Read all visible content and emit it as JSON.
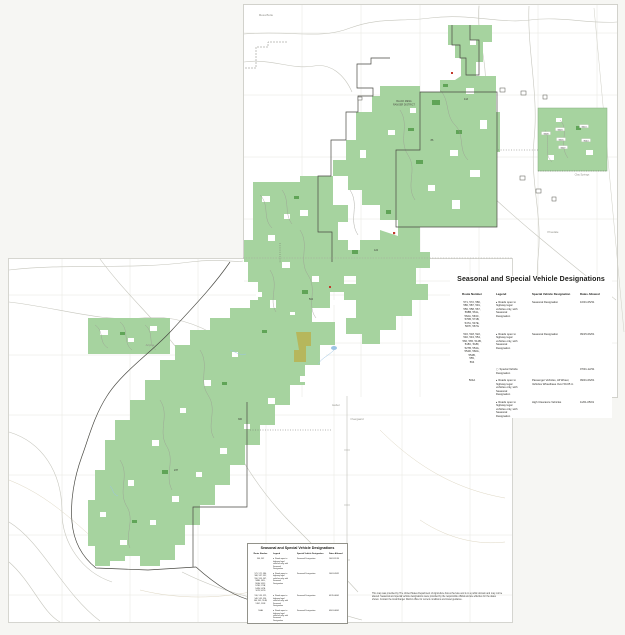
{
  "page": {
    "background": "#f6f6f3"
  },
  "map": {
    "colors": {
      "forest_green": "#a6d39f",
      "dark_green": "#59a050",
      "olive_area": "#b6b75c",
      "boundary": "#4a4a44",
      "road_gray": "#c6c6bd",
      "water_blue": "#9cc4e4",
      "marker_red": "#c23a2c",
      "paper": "#ffffff"
    },
    "labels": [
      {
        "t": "Mesa Butte",
        "x": 266,
        "y": 16,
        "s": 2.8,
        "c": "#8f8f88"
      },
      {
        "t": "BLACK MESA",
        "x": 404,
        "y": 102,
        "s": 2.4,
        "c": "#4a4a42"
      },
      {
        "t": "RANGER DISTRICT",
        "x": 404,
        "y": 105.5,
        "s": 2.4,
        "c": "#4a4a42"
      },
      {
        "t": "Clay Springs",
        "x": 582,
        "y": 175.5,
        "s": 2.6,
        "c": "#8f8f88"
      },
      {
        "t": "Pinedale",
        "x": 553,
        "y": 233,
        "s": 2.8,
        "c": "#8f8f88"
      },
      {
        "t": "Aripine",
        "x": 150,
        "y": 346,
        "s": 2.8,
        "c": "#8f8f88"
      },
      {
        "t": "Heber",
        "x": 336,
        "y": 406,
        "s": 2.8,
        "c": "#8f8f88"
      },
      {
        "t": "Overgaard",
        "x": 357,
        "y": 420,
        "s": 2.8,
        "c": "#8f8f88"
      },
      {
        "t": "300",
        "x": 240,
        "y": 420,
        "s": 2.4,
        "c": "#3a3a34"
      },
      {
        "t": "504",
        "x": 311,
        "y": 300,
        "s": 2.4,
        "c": "#3a3a34"
      },
      {
        "t": "86",
        "x": 432,
        "y": 141,
        "s": 2.4,
        "c": "#3a3a34"
      },
      {
        "t": "124",
        "x": 376,
        "y": 251,
        "s": 2.4,
        "c": "#3a3a34"
      },
      {
        "t": "237",
        "x": 176,
        "y": 471,
        "s": 2.4,
        "c": "#3a3a34"
      },
      {
        "t": "413",
        "x": 466,
        "y": 100,
        "s": 2.4,
        "c": "#3a3a34"
      }
    ],
    "route_chips": [
      {
        "t": "9408",
        "x": 546,
        "y": 134
      },
      {
        "t": "9403",
        "x": 560,
        "y": 130
      },
      {
        "t": "9413",
        "x": 584,
        "y": 127
      },
      {
        "t": "9416",
        "x": 561,
        "y": 140
      },
      {
        "t": "9044",
        "x": 586,
        "y": 141
      },
      {
        "t": "9407",
        "x": 563,
        "y": 148
      }
    ]
  },
  "legend_panel": {
    "title": "Seasonal and Special Vehicle Designations",
    "columns": [
      "Route Number",
      "Legend",
      "Special Vehicle Designation",
      "Dates Allowed"
    ],
    "rows": [
      {
        "routes": "571, 572, 580,\n586, 587, 591,\n556, 558, 567,\n568B, 561L,\n562A, 563C,\n570B, 571B,\n547A, 547E,\n567F, 567G",
        "marker": "▸",
        "legend": "Roads open to\nhighway legal\nvehicles only, with\nSeasonal\nDesignation",
        "designation": "Seasonal Designation",
        "dates": "10/01-05/31"
      },
      {
        "routes": "516, 518, 522,\n540, 543, 554,\n560, 565, 514B,\n518C, 518F,\n527B, 554A,\n554D, 560A,\n554B,\n555,\n564",
        "marker": "▸",
        "legend": "Roads open to\nhighway legal\nvehicles only, with\nSeasonal\nDesignation",
        "designation": "Seasonal Designation",
        "dates": "09/15-06/01"
      },
      {
        "routes": "",
        "marker": "▢",
        "legend": "Special Vehicle\nDesignation",
        "designation": "",
        "dates": "07/01-12/31"
      },
      {
        "routes": "504A",
        "marker": "▸",
        "legend": "Roads open to\nhighway legal\nvehicles only, with\nSeasonal\nDesignation",
        "designation": "Passenger Vehicles, All Wheel,\nVehicles Wheelbase Over 50-65 in",
        "dates": "09/01-06/01"
      },
      {
        "routes": "",
        "marker": "▸",
        "legend": "Roads open to\nhighway legal\nvehicles only, with\nSeasonal\nDesignation",
        "designation": "High Clearance Vehicles",
        "dates": "11/01-05/01"
      }
    ]
  },
  "legend_box": {
    "title": "Seasonal and Special Vehicle Designations",
    "columns": [
      "Route Number",
      "Legend",
      "Special Vehicle Designation",
      "Dates Allowed"
    ],
    "rows": [
      {
        "routes": "504, 542",
        "marker": "▸",
        "legend": "Roads open to\nhighway legal\nvehicles only, with\nSeasonal\nDesignation",
        "designation": "Seasonal Designation",
        "dates": "10/01-11/30"
      },
      {
        "routes": "571, 572, 580,\n586, 587, 591,\n556, 558, 567,\n568B, 561L,\n562A, 563C,\n570B, 571B,\n547A, 547E,\n567F, 567G",
        "marker": "▸",
        "legend": "Roads open to\nhighway legal\nvehicles only, with\nSeasonal\nDesignation",
        "designation": "Seasonal Designation",
        "dates": "10/01-05/31"
      },
      {
        "routes": "516, 518, 522,\n540, 543, 554,\n560, 565, 514B,\n518C, 518F",
        "marker": "▸",
        "legend": "Roads open to\nhighway legal\nvehicles only, with\nSeasonal\nDesignation",
        "designation": "Seasonal Designation",
        "dates": "09/15-06/01"
      },
      {
        "routes": "504A",
        "marker": "▸",
        "legend": "Roads open to\nhighway legal\nvehicles only, with\nSeasonal\nDesignation",
        "designation": "Seasonal Designation",
        "dates": "09/01-06/01"
      }
    ]
  },
  "disclaimer": "This map was provided by The United States Department of Agriculture Forest Service and is in a public domain and may not be altered. Seasonal and special vehicle designations were provided by the responsible official and are effective for the dates shown. Contact the local Ranger District office for current conditions and travel guidance."
}
